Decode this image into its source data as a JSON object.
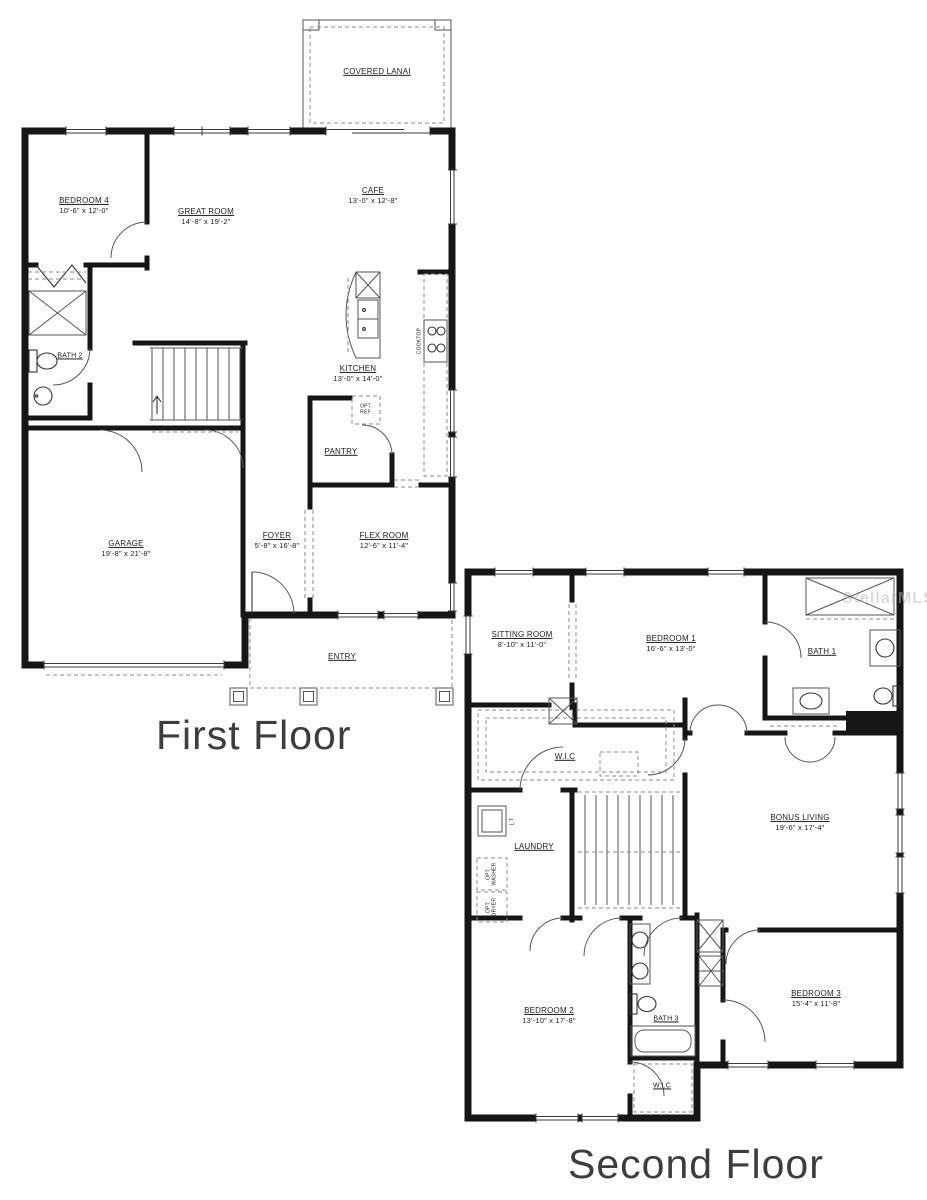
{
  "watermark": "StellarMLS",
  "first_floor": {
    "title": "First Floor",
    "rooms": {
      "covered_lanai": {
        "name": "COVERED LANAI",
        "dims": ""
      },
      "bedroom4": {
        "name": "BEDROOM 4",
        "dims": "10'-6\" x 12'-0\""
      },
      "great_room": {
        "name": "GREAT ROOM",
        "dims": "14'-8\" x 19'-2\""
      },
      "cafe": {
        "name": "CAFE",
        "dims": "13'-0\" x 12'-8\""
      },
      "kitchen": {
        "name": "KITCHEN",
        "dims": "13'-0\" x 14'-0\""
      },
      "bath2": {
        "name": "BATH 2",
        "dims": ""
      },
      "pantry": {
        "name": "PANTRY",
        "dims": ""
      },
      "foyer": {
        "name": "FOYER",
        "dims": "5'-8\" x 16'-8\""
      },
      "flex_room": {
        "name": "FLEX ROOM",
        "dims": "12'-6\" x 11'-4\""
      },
      "garage": {
        "name": "GARAGE",
        "dims": "19'-8\" x 21'-8\""
      },
      "entry": {
        "name": "ENTRY",
        "dims": ""
      }
    },
    "fixtures": {
      "opt_ref": "OPT. REF.",
      "cooktop": "COOKTOP"
    }
  },
  "second_floor": {
    "title": "Second Floor",
    "rooms": {
      "sitting_room": {
        "name": "SITTING ROOM",
        "dims": "8'-10\" x 11'-0\""
      },
      "bedroom1": {
        "name": "BEDROOM 1",
        "dims": "16'-6\" x 13'-0\""
      },
      "bath1": {
        "name": "BATH 1",
        "dims": ""
      },
      "wic_master": {
        "name": "W.I.C",
        "dims": ""
      },
      "laundry": {
        "name": "LAUNDRY",
        "dims": ""
      },
      "bonus_living": {
        "name": "BONUS LIVING",
        "dims": "19'-6\" x 17'-4\""
      },
      "bedroom2": {
        "name": "BEDROOM 2",
        "dims": "13'-10\" x 17'-8\""
      },
      "bath3": {
        "name": "BATH 3",
        "dims": ""
      },
      "bedroom3": {
        "name": "BEDROOM 3",
        "dims": "15'-4\" x 11'-8\""
      },
      "wic2": {
        "name": "W.I.C",
        "dims": ""
      }
    },
    "fixtures": {
      "laundry_tub": "L.T.",
      "washer": "OPT. WASHER",
      "dryer": "OPT. DRYER"
    }
  }
}
